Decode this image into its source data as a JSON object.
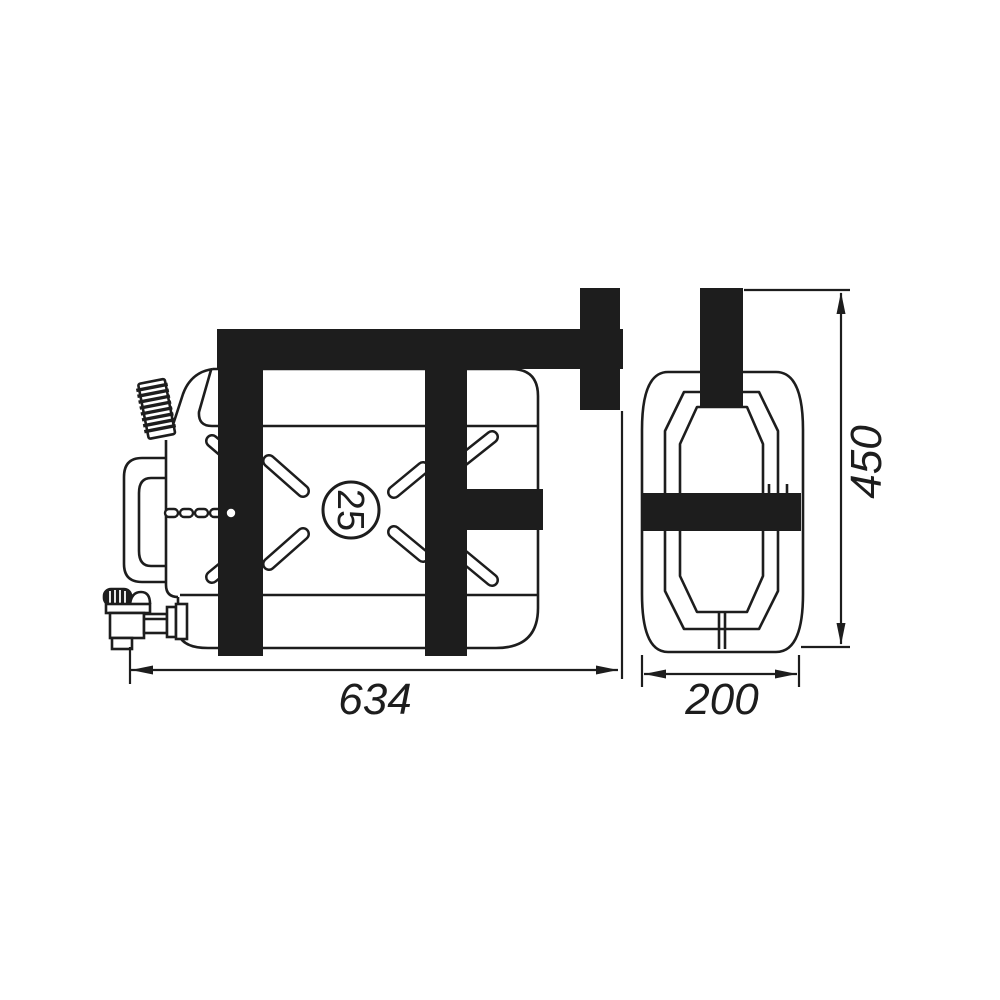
{
  "page": {
    "background": "#ffffff"
  },
  "diagram": {
    "capacity_badge": {
      "value": "25"
    },
    "dimensions": {
      "length": "634",
      "depth": "200",
      "height": "450"
    }
  },
  "colors": {
    "ink": "#1d1d1d",
    "background": "#ffffff"
  }
}
